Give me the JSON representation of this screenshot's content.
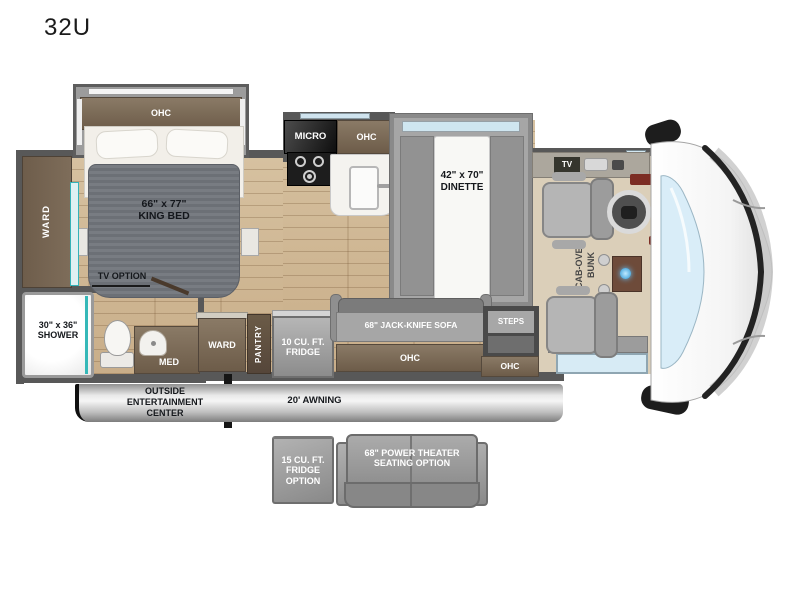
{
  "model": "32U",
  "bedroom": {
    "ohc": "OHC",
    "bed_size": "66\" x 77\"",
    "bed_name": "KING BED",
    "ward": "WARD",
    "tv_option": "TV OPTION"
  },
  "bathroom": {
    "shower_size": "30\" x 36\"",
    "shower_name": "SHOWER",
    "med": "MED"
  },
  "kitchen": {
    "micro": "MICRO",
    "ohc": "OHC"
  },
  "dinette": {
    "size": "42\" x 70\"",
    "name": "DINETTE"
  },
  "living": {
    "tv": "TV",
    "sofa": "68\" JACK-KNIFE SOFA",
    "sofa_ohc": "OHC",
    "steps": "STEPS",
    "entry_ohc": "OHC",
    "ward": "WARD",
    "pantry": "PANTRY",
    "fridge_line1": "10 CU. FT.",
    "fridge_line2": "FRIDGE"
  },
  "cab": {
    "bunk_line1": "CAB-OVER",
    "bunk_line2": "BUNK"
  },
  "exterior": {
    "oec_line1": "OUTSIDE",
    "oec_line2": "ENTERTAINMENT",
    "oec_line3": "CENTER",
    "awning": "20' AWNING"
  },
  "options": {
    "fridge_line1": "15 CU. FT.",
    "fridge_line2": "FRIDGE",
    "fridge_line3": "OPTION",
    "theater_line1": "68\" POWER THEATER",
    "theater_line2": "SEATING OPTION"
  },
  "colors": {
    "wood": "#cdb493",
    "cabinet_brown": "#7a6a55",
    "wall_gray": "#585858",
    "accent_teal": "#35b8b8",
    "windshield_blue": "#d9edf8",
    "option_gray": "#9b9b9b"
  }
}
